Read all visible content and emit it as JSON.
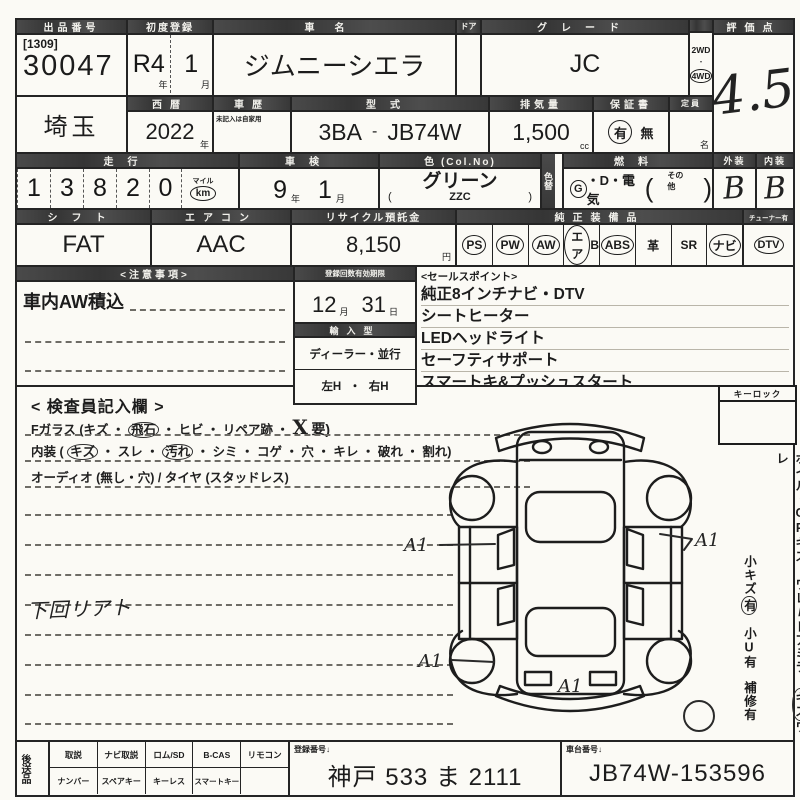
{
  "header": {
    "auction_no_label": "出品番号",
    "auction_lot_bracket": "[1309]",
    "auction_no": "30047",
    "first_reg_label": "初度登録",
    "first_reg_year": "R4",
    "first_reg_month": "1",
    "unit_year": "年",
    "unit_month": "月",
    "car_name_label": "車名",
    "car_name": "ジムニーシエラ",
    "door_label": "ドア",
    "grade_label": "グレード",
    "grade": "JC",
    "drive_2wd": "2WD",
    "drive_dot": "・",
    "drive_4wd": "4WD",
    "score_label": "評価点",
    "score": "4.5"
  },
  "row2": {
    "prefecture": "埼玉",
    "seireki_label": "西暦",
    "seireki": "2022",
    "unit_year": "年",
    "history_label": "車歴",
    "history_note": "未記入は自家用",
    "model_label": "型式",
    "model_code": "3BA",
    "model_dash": "-",
    "model": "JB74W",
    "displacement_label": "排気量",
    "displacement": "1,500",
    "unit_cc": "cc",
    "warranty_label": "保証書",
    "warranty_yes": "有",
    "warranty_no": "無",
    "capacity_label": "定員",
    "unit_name": "名"
  },
  "row3": {
    "mileage_label": "走行",
    "mileage_digits": [
      "1",
      "3",
      "8",
      "2",
      "0"
    ],
    "unit_mile": "マイル",
    "unit_km": "km",
    "shaken_label": "車検",
    "shaken_year": "9",
    "shaken_month": "1",
    "unit_year": "年",
    "unit_month": "月",
    "color_label": "色 (Col.No)",
    "color": "グリーン",
    "color_no": "ZZC",
    "paren_open": "(",
    "paren_close": ")",
    "color_change_label": "色替",
    "fuel_label": "燃料",
    "fuel_g": "G",
    "fuel_rest": "・D・電気",
    "fuel_other": "その他",
    "exterior_label": "外装",
    "exterior_grade": "B",
    "interior_label": "内装",
    "interior_grade": "B"
  },
  "row4": {
    "shift_label": "シフト",
    "shift": "FAT",
    "ac_label": "エアコン",
    "ac": "AAC",
    "recycle_label": "リサイクル預託金",
    "recycle": "8,150",
    "unit_yen": "円",
    "equipment_label": "純正装備品",
    "equipment": [
      {
        "text": "PS",
        "suffix": "",
        "circled": true
      },
      {
        "text": "PW",
        "suffix": "",
        "circled": true
      },
      {
        "text": "AW",
        "suffix": "",
        "circled": true
      },
      {
        "text": "エア",
        "suffix": "B",
        "circled": true
      },
      {
        "text": "ABS",
        "suffix": "",
        "circled": true
      },
      {
        "text": "革",
        "suffix": "",
        "circled": false
      },
      {
        "text": "SR",
        "suffix": "",
        "circled": false
      },
      {
        "text": "ナビ",
        "suffix": "",
        "circled": true
      }
    ],
    "tuner_label": "チューナー有",
    "tuner": "DTV"
  },
  "notes": {
    "label": "<注意事項>",
    "line1": "車内AW積込"
  },
  "registration": {
    "label": "登録回数有効期限",
    "month": "12",
    "unit_month": "月",
    "day": "31",
    "unit_day": "日"
  },
  "import_type": {
    "label": "輸入型",
    "dealer": "ディーラー・並行",
    "handle_left": "左H",
    "handle_sep": "・",
    "handle_right": "右H"
  },
  "sales_points": {
    "label": "<セールスポイント>",
    "items": [
      "純正8インチナビ・DTV",
      "シートヒーター",
      "LEDヘッドライト",
      "セーフティサポート",
      "スマートキ&プッシュスタート"
    ]
  },
  "inspector": {
    "title": "< 検査員記入欄 >",
    "glass_pre": "Fガラス (キズ ・",
    "glass_circled": "飛石",
    "glass_mid": "・ ヒビ ・ リペア跡 ・",
    "glass_x": "X",
    "glass_end": "要)",
    "interior_pre": "内装 (",
    "interior_c1": "キズ",
    "interior_m1": "・ スレ ・",
    "interior_c2": "汚れ",
    "interior_end": "・ シミ ・ コゲ ・ 穴 ・ キレ ・ 破れ ・ 割れ)",
    "audio_line": "オーディオ (無し・穴) / タイヤ (スタッドレス)",
    "handwritten_note": "下回リアト",
    "keylock_label": "キーロック"
  },
  "right_notes": {
    "col1_pre": "ホイル・CPキズ ワレ",
    "col1_slash": "/",
    "col1_mid": "ドアミラー",
    "col1_circled": "キズ",
    "col1_end": "ワレ",
    "col2_pre": "小キズ",
    "col2_circled": "有",
    "col2_mid": "小U有",
    "col2_end": "補修有"
  },
  "diagram": {
    "marks": [
      "A1",
      "A1",
      "A1",
      "A1"
    ]
  },
  "footer": {
    "later_items_label": "後送品",
    "row1": [
      "取説",
      "ナビ取説",
      "ロム/SD",
      "B-CAS",
      "リモコン"
    ],
    "row2": [
      "ナンバー",
      "スペアキー",
      "キーレス",
      "スマートキー",
      ""
    ],
    "reg_no_label": "登録番号↓",
    "reg_no": "神戸 533 ま 2111",
    "chassis_label": "車台番号↓",
    "chassis_no": "JB74W-153596"
  },
  "colors": {
    "ink": "#1c1c1c",
    "header_bg": "#3f3f3f",
    "paper": "#fbfaf5"
  }
}
